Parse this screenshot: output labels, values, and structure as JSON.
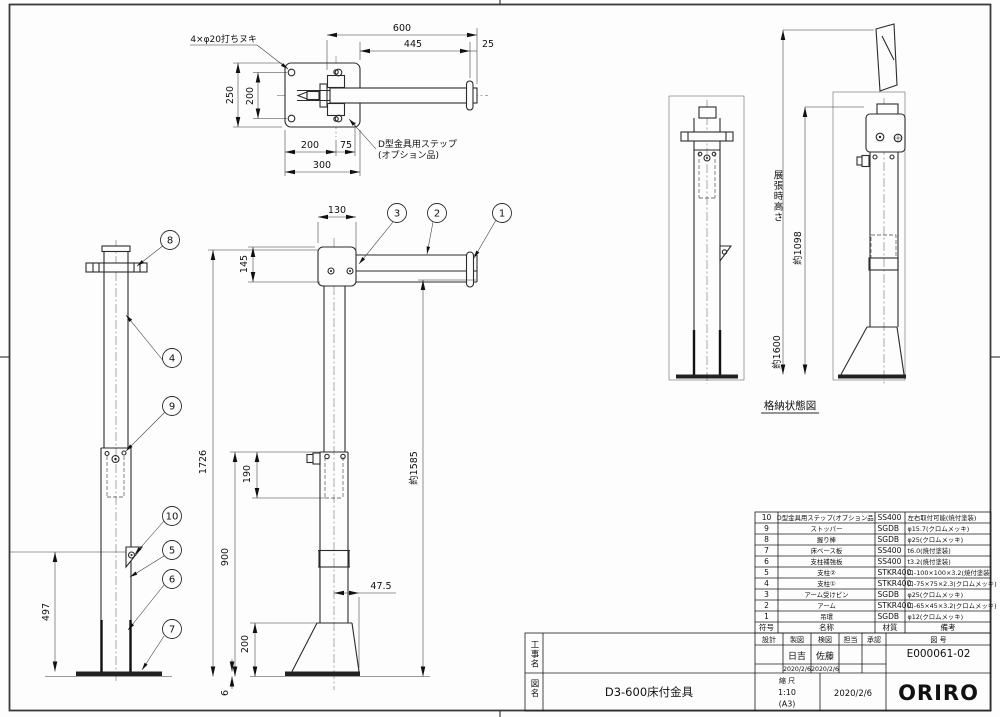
{
  "drawing": {
    "punch_note": "4×φ20打ちヌキ",
    "step_note1": "D型金具用ステップ",
    "step_note2": "(オプション品)",
    "stored_caption": "格納状態図",
    "deployed_height_label": "展張時高さ",
    "deployed_height_value": "約1600",
    "stored_height": "約1098",
    "dims": {
      "d600": "600",
      "d445": "445",
      "d25": "25",
      "d250": "250",
      "d200L": "200",
      "d200b": "200",
      "d75": "75",
      "d300": "300",
      "d130": "130",
      "d145": "145",
      "d1726": "1726",
      "d190": "190",
      "d900": "900",
      "d200c": "200",
      "d6": "6",
      "d47": "47.5",
      "d1585": "約1585",
      "d497": "497"
    },
    "balloons": [
      "1",
      "2",
      "3",
      "4",
      "5",
      "6",
      "7",
      "8",
      "9",
      "10"
    ]
  },
  "parts_table": {
    "header": {
      "no": "符号",
      "name": "名称",
      "material": "材質",
      "remarks": "備考"
    },
    "rows": [
      {
        "no": "10",
        "name": "D型金具用ステップ(オプション品)",
        "material": "SS400",
        "remarks": "左右取付可能(焼付塗装)"
      },
      {
        "no": "9",
        "name": "ストッパー",
        "material": "SGDB",
        "remarks": "φ15.7(クロムメッキ)"
      },
      {
        "no": "8",
        "name": "握り棒",
        "material": "SGDB",
        "remarks": "φ25(クロムメッキ)"
      },
      {
        "no": "7",
        "name": "床ベース板",
        "material": "SS400",
        "remarks": "t6.0(焼付塗装)"
      },
      {
        "no": "6",
        "name": "支柱補強板",
        "material": "SS400",
        "remarks": "t3.2(焼付塗装)"
      },
      {
        "no": "5",
        "name": "支柱②",
        "material": "STKR400",
        "remarks": "ロ-100×100×3.2(焼付塗装)"
      },
      {
        "no": "4",
        "name": "支柱①",
        "material": "STKR400",
        "remarks": "ロ-75×75×2.3(クロムメッキ)"
      },
      {
        "no": "3",
        "name": "アーム受けピン",
        "material": "SGDB",
        "remarks": "φ25(クロムメッキ)"
      },
      {
        "no": "2",
        "name": "アーム",
        "material": "STKR400",
        "remarks": "ロ-65×45×3.2(クロムメッキ)"
      },
      {
        "no": "1",
        "name": "吊環",
        "material": "SGDB",
        "remarks": "φ12(クロムメッキ)"
      }
    ]
  },
  "title_block": {
    "project_label": "工事名",
    "drawing_label": "図名",
    "drawing_name": "D3-600床付金具",
    "col_design": "設計",
    "col_draft": "製図",
    "col_check": "検図",
    "col_charge": "担当",
    "col_approve": "承認",
    "col_no": "図 号",
    "draft_name": "日吉",
    "draft_date": "2020/2/6",
    "check_name": "佐藤",
    "check_date": "2020/2/6",
    "scale_label": "縮 尺",
    "scale": "1:10",
    "sheet": "(A3)",
    "date": "2020/2/6",
    "drawing_no": "E000061-02",
    "company": "ORIRO"
  }
}
